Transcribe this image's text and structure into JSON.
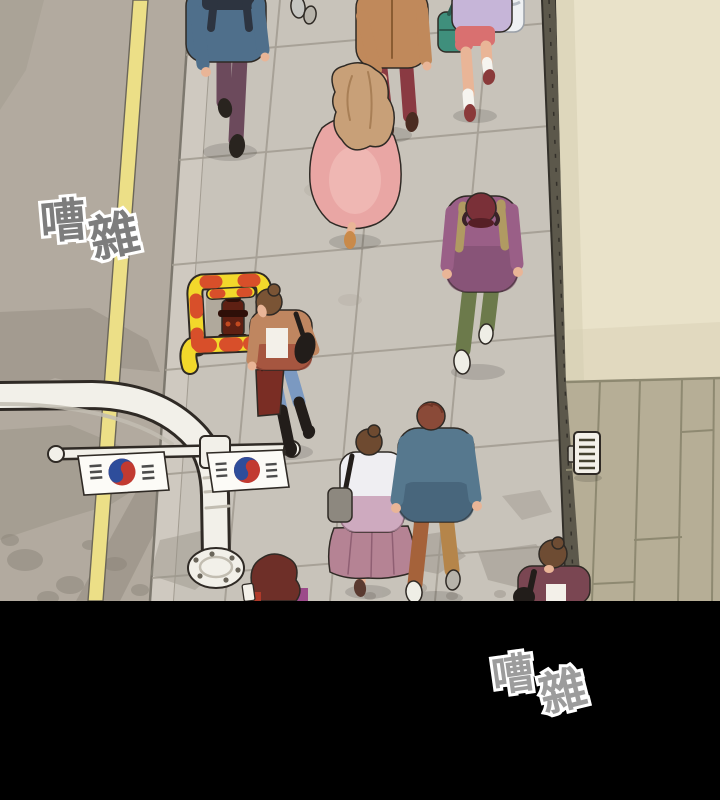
{
  "panel": {
    "sfx_top": {
      "char1": "嘈",
      "char2": "雜"
    },
    "sfx_bottom": {
      "char1": "嘈",
      "char2": "雜"
    }
  },
  "palette": {
    "outline": "#2f2a25",
    "road": "#b2aa9f",
    "roadShadow": "#8c857a",
    "laneYellow": "#ecdf87",
    "laneEdge": "#6b665a",
    "curbLight": "#cfc9c0",
    "sidewalk": "#c8c3ba",
    "tileJoint": "#a29c91",
    "stainGray": "#9a948a",
    "stripDark": "#5c584b",
    "stripEdge": "#33302a",
    "wall": "#e9e2c9",
    "wallShade": "#d5cdb1",
    "deck": "#b6ae96",
    "deckJoint": "#8e8971",
    "poleWhite": "#f2f0e9",
    "poleShade": "#c2bdb1",
    "flagWhite": "#fcfbf7",
    "flagRed": "#c23a31",
    "flagBlue": "#2e4d9b",
    "trigram": "#4c4c4c",
    "cageYellow": "#f2d82b",
    "cageRed": "#d84f2a",
    "hydrantBody": "#5e2013",
    "hydrantDark": "#2e0f08",
    "hydrantAccent": "#c2491f",
    "skin": "#e9b597",
    "sneakerWhite": "#efeee6",
    "sneakerGray": "#b7b3aa",
    "shoeDark": "#29241f",
    "sockWhite": "#f6f4ef",
    "whiteCloth": "#f3f0e9",
    "blackItem": "#221d1a",
    "letterbox": "#000000",
    "sfxTopFill": "#7d7d7d",
    "sfxBottomFill": "#9c9c9c",
    "sfxOutline": "#ffffff",
    "p1Jacket": "#4f6f8b",
    "p1Pants": "#6c4a5c",
    "p1Strap": "#2d3440",
    "p2Shoe": "#c6c6c2",
    "p2Cuff": "#3c3c46",
    "p3Jacket": "#c0895b",
    "p3Pants": "#8a3a42",
    "p3Shoe": "#4a2c22",
    "p3wHair": "#c8a078",
    "p3wDress": "#e9a6a4",
    "p3wDressLight": "#f4c4c0",
    "p3wShoe": "#c98a4a",
    "p4Top": "#c6b5d8",
    "p4Bag": "#3f8f7c",
    "p4BagDark": "#2c5c50",
    "p4Shorts": "#d97070",
    "p4Shoe": "#8a3a3a",
    "p5Bag": "#eef0f2",
    "p6Jacket": "#9a5f87",
    "p6JacketDark": "#7a4a6b",
    "p6Cap": "#7a3038",
    "p6CapBrim": "#561f26",
    "p6Strap": "#b09a62",
    "p6Pants": "#6c7a4b",
    "p7Hair": "#7a5435",
    "p7Jacket": "#bf8660",
    "p7JacketLow": "#a04a38",
    "p7Jeans": "#7b99c1",
    "p7Bag": "#7a2d24",
    "p8wHair": "#6e4a30",
    "p8wTop": "#efeef2",
    "p8wTopLow": "#c393ad",
    "p8wSkirt": "#b58394",
    "p8wSkirtLine": "#8f5f73",
    "p8wBag": "#8d887f",
    "p8wShoe": "#5a3a30",
    "p8mHair": "#8a4a38",
    "p8mJacket": "#56788e",
    "p8mJacketLow": "#3f5a70",
    "p8mPantsL": "#a5623a",
    "p8mPantsR": "#b5854a",
    "p9Hair": "#6e2f28",
    "p9Top": "#9c4a8a",
    "p9Red": "#b03a2a",
    "p10Hair": "#6e4c33",
    "p10Jacket": "#7a4652"
  },
  "figures": [
    {
      "name": "man-blue-jacket",
      "description": "man in blue-gray jacket with dark backpack straps and plum trousers, top left"
    },
    {
      "name": "pedestrian-shoes",
      "description": "pedestrian mostly out of frame at top, gray sneakers"
    },
    {
      "name": "couple-camel-jacket-man",
      "description": "man in camel jacket and dark red trousers holding hands"
    },
    {
      "name": "woman-pink-dress",
      "description": "woman with long wavy sandy hair in flowing pink dress"
    },
    {
      "name": "woman-lavender-top",
      "description": "woman in lavender top, coral shorts, teal bag, white socks, top right"
    },
    {
      "name": "partial-pale-bag",
      "description": "edge of a pedestrian with pale bag at top right corner"
    },
    {
      "name": "man-purple-sweatshirt",
      "description": "man in plum sweatshirt, dark red cap, khaki backpack straps, olive trousers, white sneakers"
    },
    {
      "name": "woman-tan-jacket-jeans",
      "description": "woman with bun, open tan jacket, white crop top, blue jeans, black boots, dark red shopping bag beside yellow hydrant guard"
    },
    {
      "name": "couple-woman-skirt",
      "description": "woman with bun, white-to-mauve top, flared mauve skirt, gray shoulder bag"
    },
    {
      "name": "couple-man-denim",
      "description": "man with auburn hair, blue-gray jacket, rust trousers, white sneakers"
    },
    {
      "name": "woman-maroon-hair-partial",
      "description": "partial figure with wavy maroon hair and magenta top at bottom panel edge"
    },
    {
      "name": "woman-plum-jacket-partial",
      "description": "woman with bun, plum jacket and white top at lower right, cropped by panel edge"
    }
  ],
  "objects": [
    {
      "name": "street-lamp",
      "description": "white curved lamp pole with segmented post and round base plate"
    },
    {
      "name": "korean-flag-left",
      "description": "South Korean flag hanging from crossbar"
    },
    {
      "name": "korean-flag-right",
      "description": "South Korean flag hanging from crossbar"
    },
    {
      "name": "hydrant-guard",
      "description": "yellow guard frame with red stripes around a dark red fire hydrant"
    },
    {
      "name": "intercom-panel",
      "description": "small wall-mounted panel with slats on wooden deck"
    }
  ]
}
